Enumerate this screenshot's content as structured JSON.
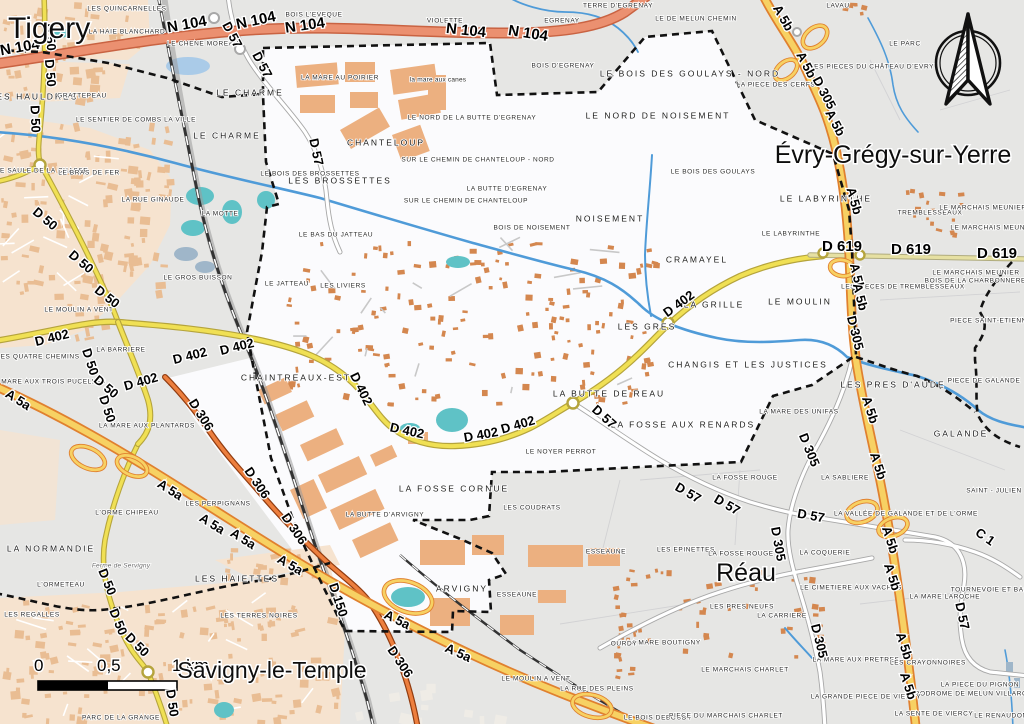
{
  "map": {
    "title": "Carte de Moissy-Cramayel et communes voisines",
    "scale_bar": {
      "t0": "0",
      "t1": "0,5",
      "t2": "1 km"
    },
    "colors": {
      "motorway_fill": "#f7d163",
      "motorway_casing": "#e0802f",
      "trunk_fill": "#eb9070",
      "trunk_casing": "#c96342",
      "secondary_fill": "#f0e054",
      "secondary_casing": "#b5a43c",
      "d619_fill": "#e6e0a2",
      "d306_fill": "#ed7f3e",
      "d306_casing": "#913c10",
      "water": "#4f9bd8",
      "pond": "#5fc2c6",
      "commune_fill": "#fbfbfd",
      "land": "#e9e8e6",
      "urban": "#f6e3cf",
      "building": "#e9bd93",
      "building_dark": "#d4874f",
      "boundary": "#111111"
    },
    "cities": [
      [
        "Tigery",
        8,
        38,
        30,
        "start"
      ],
      [
        "Évry-Grégy-sur-Yerre",
        893,
        163,
        25,
        "middle"
      ],
      [
        "Réau",
        746,
        581,
        25,
        "middle"
      ],
      [
        "Savigny-le-Temple",
        272,
        678,
        23,
        "middle"
      ]
    ],
    "places": [
      [
        "LES QUINCARNELLES",
        127,
        8
      ],
      [
        "LA HAIE BLANCHARD",
        127,
        31
      ],
      [
        "LE CHENE MOREAU",
        203,
        43
      ],
      [
        "LES HAULDRES",
        34,
        97,
        "lg"
      ],
      [
        "GRATTEPEAU",
        82,
        95
      ],
      [
        "LE CHARME",
        250,
        93,
        "lg"
      ],
      [
        "BOIS L'EVEQUE",
        314,
        14
      ],
      [
        "VIOLETTE",
        445,
        20
      ],
      [
        "EGRENAY",
        562,
        20
      ],
      [
        "TERRE D'EGRENAY",
        618,
        5
      ],
      [
        "LE DE MELUN CHEMIN",
        696,
        18
      ],
      [
        "LAVAU",
        838,
        5
      ],
      [
        "LE PARC",
        905,
        43
      ],
      [
        "LES PIECES DU CHÂTEAU D'EVRY",
        872,
        66
      ],
      [
        "LA PIECE DES CERFS",
        776,
        84
      ],
      [
        "LE BOIS DES GOULAYS - NORD",
        690,
        74,
        "lg"
      ],
      [
        "LE NORD DE LA BUTTE D'EGRENAY",
        472,
        117
      ],
      [
        "LE NORD DE NOISEMENT",
        658,
        116,
        "lg"
      ],
      [
        "LE SENTIER DE COMBS LA VILLE",
        136,
        119
      ],
      [
        "LE CHARME",
        227,
        136,
        "lg"
      ],
      [
        "CHANTELOUP",
        386,
        143,
        "lg"
      ],
      [
        "LA MARE AU POIRIER",
        340,
        77
      ],
      [
        "la mare aux canes",
        438,
        79,
        "lc"
      ],
      [
        "BOIS D'EGRENAY",
        563,
        65
      ],
      [
        "LE SAULE DE LA CHASSE",
        42,
        170
      ],
      [
        "LE BRAS DE FER",
        89,
        172
      ],
      [
        "LES BROSSETTES",
        340,
        181,
        "lg"
      ],
      [
        "LE BOIS DES BROSSETTES",
        310,
        173
      ],
      [
        "LA BUTTE D'EGRENAY",
        507,
        188
      ],
      [
        "SUR LE CHEMIN DE CHANTELOUP - NORD",
        478,
        159
      ],
      [
        "SUR LE CHEMIN DE CHANTELOUP",
        466,
        200
      ],
      [
        "BOIS DE NOISEMENT",
        532,
        227
      ],
      [
        "LA MOTTE",
        220,
        213
      ],
      [
        "LA RUE GINAUDE",
        153,
        199
      ],
      [
        "NOISEMENT",
        610,
        219,
        "lg"
      ],
      [
        "LE BOIS DES GOULAYS",
        713,
        171
      ],
      [
        "LE LABYRINTHE",
        826,
        199,
        "lg"
      ],
      [
        "LE LABYRINTHE",
        791,
        233
      ],
      [
        "CRAMAYEL",
        697,
        260,
        "lg"
      ],
      [
        "TREMBLESSEAUX",
        930,
        212
      ],
      [
        "LE MARCHAIS MEUNIER",
        983,
        207
      ],
      [
        "LE MARCHAIS MEUNIER",
        994,
        227
      ],
      [
        "LE MARCHAIS MEUNIER",
        976,
        272
      ],
      [
        "BOIS DE LA CHARBONNERELLE",
        982,
        280
      ],
      [
        "LES PIECES DE TREMBLESSEAUX",
        903,
        286
      ],
      [
        "PIECE SAINT-ETIENNE",
        991,
        320
      ],
      [
        "LE GROS BUISSON",
        198,
        277
      ],
      [
        "LE JATTEAU",
        287,
        283
      ],
      [
        "LES LIVIERS",
        343,
        285
      ],
      [
        "LE BAS DU JATTEAU",
        336,
        234
      ],
      [
        "LE MOULIN A VENT",
        79,
        309
      ],
      [
        "LES QUATRE CHEMINS",
        38,
        356
      ],
      [
        "LA BARRIERE",
        121,
        349
      ],
      [
        "LA MARE AUX TROIS PUCELLES",
        48,
        381
      ],
      [
        "LA MARE AUX PLANTARDS",
        147,
        425
      ],
      [
        "LA GRILLE",
        714,
        305,
        "lg"
      ],
      [
        "LE MOULIN",
        800,
        302,
        "lg"
      ],
      [
        "LES GRES",
        647,
        327,
        "lg"
      ],
      [
        "CHANGIS ET LES JUSTICES",
        748,
        365,
        "lg"
      ],
      [
        "LA MARE DES UNIFAS",
        799,
        411
      ],
      [
        "LES PRES D'AUDE",
        893,
        385,
        "lg"
      ],
      [
        "PIECE DE GALANDE",
        984,
        380
      ],
      [
        "GALANDE",
        961,
        434,
        "lg"
      ],
      [
        "LA SABLIERE",
        845,
        477
      ],
      [
        "SAINT - JULIEN",
        994,
        490
      ],
      [
        "LA VALLÉE DE GALANDE ET DE L'ORME",
        906,
        513
      ],
      [
        "LA BUTTE DE REAU",
        609,
        394,
        "lg"
      ],
      [
        "LA FOSSE AUX RENARDS",
        683,
        425,
        "lg"
      ],
      [
        "LA FOSSE ROUGE",
        745,
        477
      ],
      [
        "LE NOYER PERROT",
        561,
        451
      ],
      [
        "LA FOSSE CORNUE",
        454,
        489,
        "lg"
      ],
      [
        "LES COUDRATS",
        532,
        507
      ],
      [
        "LES EPINETTES",
        686,
        549
      ],
      [
        "LA FOSSE ROUGE",
        741,
        553
      ],
      [
        "ESSEAUNE",
        606,
        551
      ],
      [
        "ESSEAUNE",
        517,
        594
      ],
      [
        "ARVIGNY",
        462,
        589,
        "lg"
      ],
      [
        "CHAINTREAUX-EST",
        296,
        378,
        "lg"
      ],
      [
        "LA BUTTE D'ARVIGNY",
        385,
        514
      ],
      [
        "LES PERPIGNANS",
        218,
        503
      ],
      [
        "L'ORME CHIPEAU",
        127,
        512
      ],
      [
        "LA NORMANDIE",
        51,
        549,
        "lg"
      ],
      [
        "Ferme de Servigny",
        121,
        565,
        "farm"
      ],
      [
        "L'ORMETEAU",
        61,
        584
      ],
      [
        "LES REGALLES",
        32,
        614
      ],
      [
        "LES HAIETTES",
        237,
        579,
        "lg"
      ],
      [
        "LES TERRES NOIRES",
        259,
        615
      ],
      [
        "PARC DE LA GRANGE",
        121,
        717
      ],
      [
        "LE MOULIN A VENT",
        536,
        678
      ],
      [
        "LA RUE DES PLEINS",
        597,
        688
      ],
      [
        "LE BOIS DEBOUDY",
        658,
        717
      ],
      [
        "PIECE DU MARCHAIS CHARLET",
        726,
        715
      ],
      [
        "LE MARCHAIS CHARLET",
        745,
        669
      ],
      [
        "LA MARE BOUTIGNY",
        664,
        642
      ],
      [
        "OURDY",
        624,
        643
      ],
      [
        "LES PRES NEUFS",
        742,
        606
      ],
      [
        "LA CARRIERE",
        782,
        615
      ],
      [
        "LA COQUERIE",
        825,
        552
      ],
      [
        "LE CIMETIERE AUX VACHES",
        851,
        587
      ],
      [
        "LA MARE LAROCHE",
        945,
        596
      ],
      [
        "TOURNEVOIE ET BASSIN",
        996,
        589
      ],
      [
        "LA MARE AUX PRETRES",
        856,
        659
      ],
      [
        "LES CRAYONNOIRES",
        928,
        662
      ],
      [
        "LA PIECE DU PIGNON",
        980,
        684
      ],
      [
        "AERODROME DE MELUN VILLAROCHE",
        974,
        693
      ],
      [
        "LA GRANDE PIECE DE VIERCY",
        866,
        696
      ],
      [
        "LA SENTE DE VIERCY",
        934,
        713
      ],
      [
        "LE RENAUDON",
        1001,
        715
      ]
    ],
    "road_labels": [
      [
        "N 104",
        20,
        48,
        -10,
        15
      ],
      [
        "N 104",
        187,
        25,
        -10,
        15
      ],
      [
        "N 104",
        256,
        21,
        -12,
        15
      ],
      [
        "N 104",
        305,
        26,
        -8,
        15
      ],
      [
        "N 104",
        466,
        31,
        6,
        15
      ],
      [
        "N 104",
        528,
        34,
        9,
        15
      ],
      [
        "D 57",
        232,
        35,
        62
      ],
      [
        "D 57",
        262,
        65,
        62
      ],
      [
        "D 57",
        316,
        152,
        78
      ],
      [
        "D 57",
        604,
        417,
        42
      ],
      [
        "D 57",
        688,
        493,
        30
      ],
      [
        "D 57",
        727,
        505,
        30
      ],
      [
        "D 57",
        811,
        516,
        10
      ],
      [
        "D 57",
        962,
        616,
        78
      ],
      [
        "D 50",
        50,
        37,
        85
      ],
      [
        "D 50",
        50,
        73,
        85
      ],
      [
        "D 50",
        35,
        119,
        88
      ],
      [
        "D 50",
        45,
        219,
        40
      ],
      [
        "D 50",
        81,
        262,
        40
      ],
      [
        "D 50",
        107,
        297,
        38
      ],
      [
        "D 50",
        90,
        362,
        72
      ],
      [
        "D 50",
        106,
        387,
        40
      ],
      [
        "D 50",
        107,
        409,
        72
      ],
      [
        "D 50",
        107,
        582,
        68
      ],
      [
        "D 50",
        118,
        622,
        68
      ],
      [
        "D 50",
        137,
        645,
        45
      ],
      [
        "D 50",
        172,
        703,
        82
      ],
      [
        "D 402",
        52,
        338,
        -14
      ],
      [
        "D 402",
        190,
        356,
        -14
      ],
      [
        "D 402",
        237,
        347,
        -14
      ],
      [
        "D 402",
        141,
        382,
        -16
      ],
      [
        "D 402",
        361,
        389,
        64
      ],
      [
        "D 402",
        407,
        431,
        12
      ],
      [
        "D 402",
        481,
        435,
        -10
      ],
      [
        "D 402",
        518,
        425,
        -16
      ],
      [
        "D 402",
        679,
        304,
        -36
      ],
      [
        "D 619",
        842,
        247,
        0,
        15
      ],
      [
        "D 619",
        911,
        250,
        0,
        15
      ],
      [
        "D 619",
        997,
        254,
        0,
        15
      ],
      [
        "D 306",
        201,
        415,
        58
      ],
      [
        "D 306",
        257,
        483,
        56
      ],
      [
        "D 306",
        294,
        529,
        56
      ],
      [
        "D 306",
        400,
        662,
        56
      ],
      [
        "D 150",
        338,
        600,
        72
      ],
      [
        "A 5a",
        18,
        400,
        32
      ],
      [
        "A 5a",
        170,
        490,
        32
      ],
      [
        "A 5a",
        212,
        524,
        32
      ],
      [
        "A 5a",
        243,
        539,
        32
      ],
      [
        "A 5a",
        290,
        565,
        30
      ],
      [
        "A 5a",
        397,
        620,
        26
      ],
      [
        "A 5a",
        458,
        653,
        24
      ],
      [
        "A 5b",
        783,
        18,
        60
      ],
      [
        "A 5b",
        806,
        65,
        62
      ],
      [
        "A 5b",
        835,
        123,
        62
      ],
      [
        "A 5b",
        854,
        201,
        74
      ],
      [
        "A 5b",
        857,
        277,
        76
      ],
      [
        "A 5b",
        860,
        297,
        76
      ],
      [
        "A 5b",
        870,
        410,
        72
      ],
      [
        "A 5b",
        878,
        466,
        72
      ],
      [
        "A 5b",
        890,
        540,
        72
      ],
      [
        "A 5b",
        892,
        577,
        72
      ],
      [
        "A 5b",
        904,
        646,
        72
      ],
      [
        "A 5b",
        908,
        686,
        72
      ],
      [
        "D 305",
        824,
        93,
        62
      ],
      [
        "D 305",
        855,
        333,
        76
      ],
      [
        "D 305",
        809,
        450,
        68
      ],
      [
        "D 305",
        778,
        544,
        80
      ],
      [
        "D 305",
        819,
        641,
        76
      ],
      [
        "C 1",
        985,
        537,
        35
      ]
    ],
    "compass": {
      "name": "north-arrow"
    }
  }
}
